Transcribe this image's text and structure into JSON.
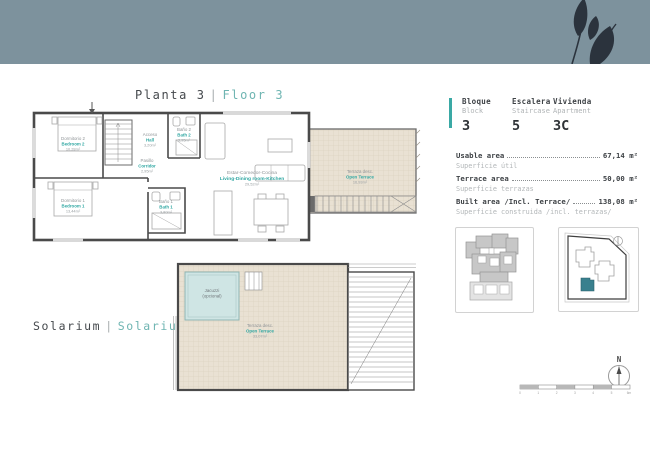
{
  "page": {
    "title_floor": {
      "es": "Planta 3",
      "sep": "|",
      "en": "Floor 3"
    },
    "title_solarium": {
      "es": "Solarium",
      "sep": "|",
      "en": "Solarium"
    }
  },
  "info_panel": {
    "block": {
      "label_es": "Bloque",
      "label_en": "Block",
      "value": "3"
    },
    "staircase": {
      "label_es": "Escalera",
      "label_en": "Staircase",
      "value": "5"
    },
    "apartment": {
      "label_es": "Vivienda",
      "label_en": "Apartment",
      "value": "3C"
    },
    "areas": [
      {
        "en": "Usable area",
        "es": "Superficie útil",
        "value": "67,14 m²"
      },
      {
        "en": "Terrace area",
        "es": "Superficie terrazas",
        "value": "50,00 m²"
      },
      {
        "en": "Built area /Incl. Terrace/",
        "es": "Superficie construida /incl. terrazas/",
        "value": "138,08 m²"
      }
    ]
  },
  "plan": {
    "rooms": {
      "bedroom2": {
        "es": "Dormitorio 2",
        "en": "Bedroom 2",
        "area": "10,28m²"
      },
      "bedroom1": {
        "es": "Dormitorio 1",
        "en": "Bedroom 1",
        "area": "13,44m²"
      },
      "hall": {
        "es": "Acceso",
        "en": "Hall",
        "area": "3,20m²"
      },
      "corridor": {
        "es": "Pasillo",
        "en": "Corridor",
        "area": "2,95m²"
      },
      "bath2": {
        "es": "Baño 2",
        "en": "Bath 2",
        "area": "3,95m²"
      },
      "bath1": {
        "es": "Baño 1",
        "en": "Bath 1",
        "area": "3,80m²"
      },
      "living": {
        "es": "Estar-Comedor-Cocina",
        "en": "Living-Dining room-Kitchen",
        "area": "29,52m²"
      },
      "terrace": {
        "es": "Terraza desc.",
        "en": "Open Terrace",
        "area": "16,93m²"
      }
    }
  },
  "solarium_plan": {
    "jacuzzi": {
      "line1": "Jacuzzi",
      "line2": "(opcional)"
    },
    "terrace": {
      "es": "Terraza desc.",
      "en": "Open Terrace",
      "area": "33,07m²"
    }
  },
  "compass": {
    "label": "N"
  },
  "scale_bar": {
    "ticks": [
      "0",
      "1",
      "2",
      "3",
      "4",
      "5",
      "6m"
    ]
  },
  "colors": {
    "band": "#7d929d",
    "accent_teal": "#3aa9a5",
    "label_teal": "#2fa7a2",
    "wall": "#4a4a4a",
    "terrace_fill": "#e9e1d3",
    "site_highlight": "#39808e"
  }
}
